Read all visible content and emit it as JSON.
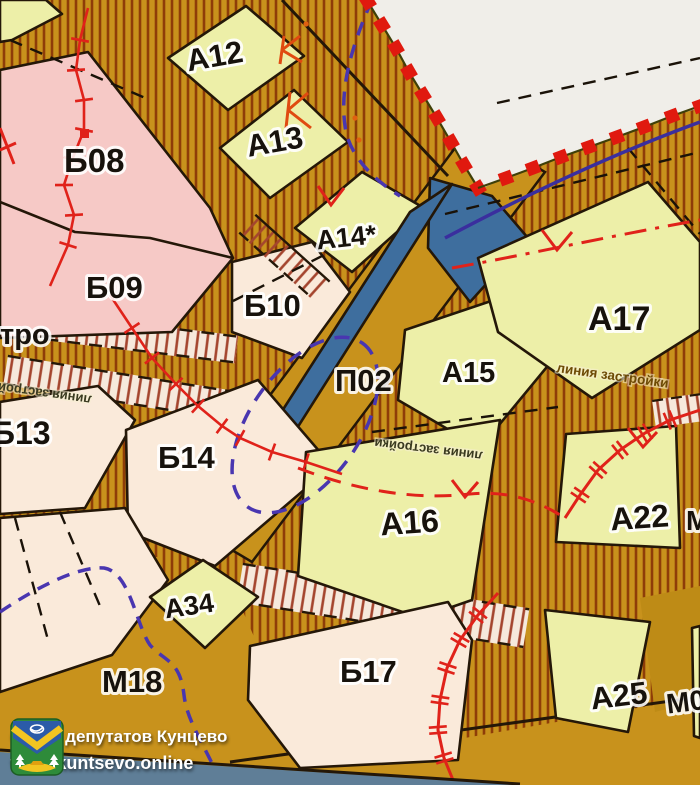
{
  "colors": {
    "road": "#C8921C",
    "road_dark": "#BE8B16",
    "hatch": "#8E3D08",
    "strip_base": "#F6E9DC",
    "strip_tick": "#A4452E",
    "zone_pink": "#F6C9C6",
    "zone_cream": "#FAEADA",
    "zone_yellow": "#EDEFA8",
    "zone_blue": "#3E6E9E",
    "outside": "#F0EEE9",
    "red": "#E0221A",
    "purple_dash": "#4936B0",
    "purple_solid": "#3A2E9E",
    "line_black": "#241708",
    "footer_band": "#5F7E97"
  },
  "map": {
    "zone_labels": [
      {
        "text": "А12"
      },
      {
        "text": "А13"
      },
      {
        "text": "Б08"
      },
      {
        "text": "Б09"
      },
      {
        "text": "А14*"
      },
      {
        "text": "Б10"
      },
      {
        "text": "П02"
      },
      {
        "text": "А15"
      },
      {
        "text": "А17"
      },
      {
        "text": "Б13"
      },
      {
        "text": "Б14"
      },
      {
        "text": "А16"
      },
      {
        "text": "А22"
      },
      {
        "text": "А34"
      },
      {
        "text": "М18"
      },
      {
        "text": "Б17"
      },
      {
        "text": "А25"
      },
      {
        "text": "М0"
      },
      {
        "text": "М"
      }
    ],
    "annotations": {
      "building_line": "линия застройки",
      "metro_fragment": "тро"
    }
  },
  "footer": {
    "org_name": "Совет депутатов Кунцево",
    "website": "www.kuntsevo.online"
  }
}
